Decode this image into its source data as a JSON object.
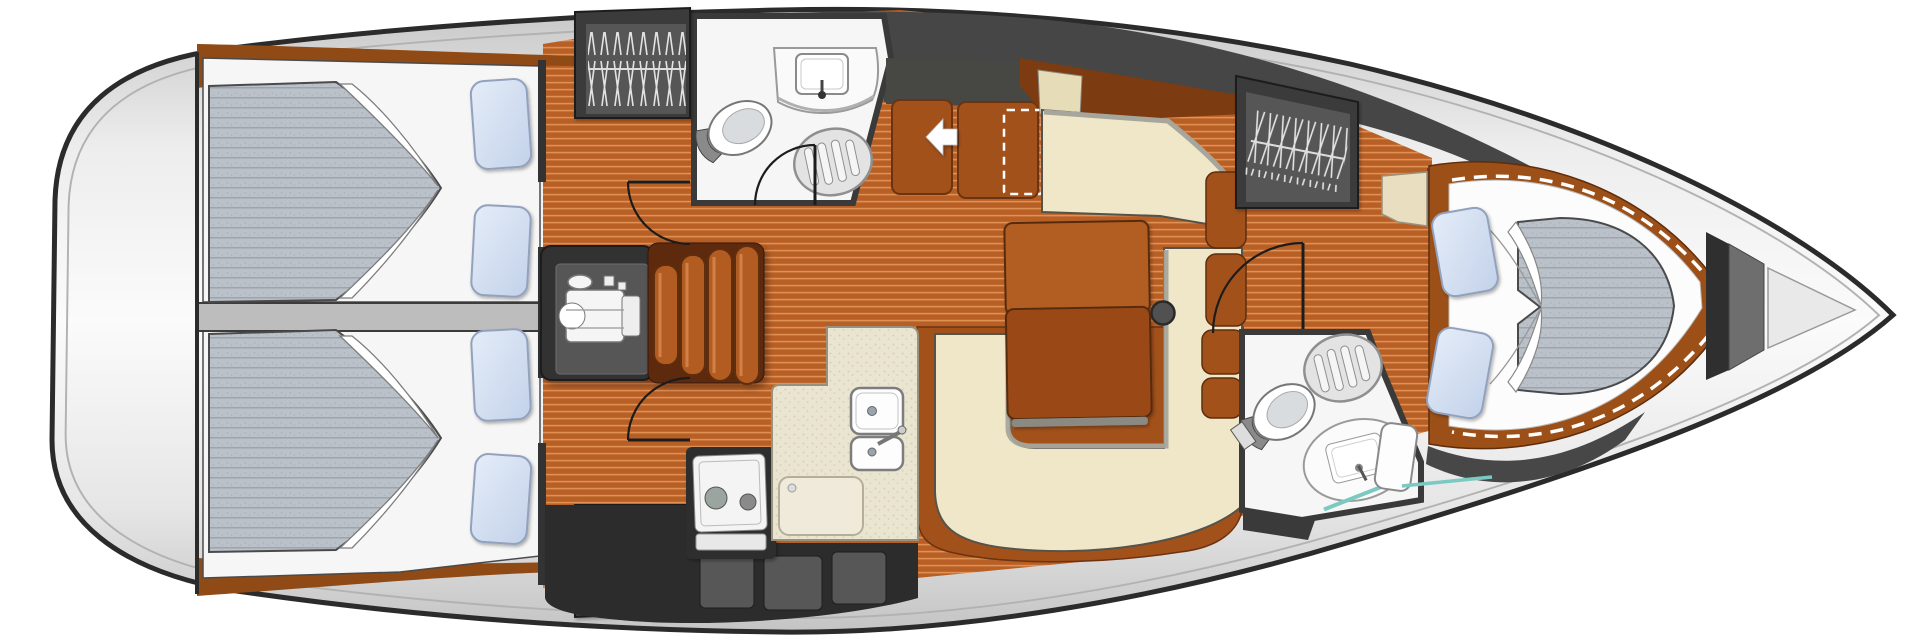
{
  "meta": {
    "title": "Sailing yacht interior layout — overhead deck plan",
    "view": "top-down floor plan",
    "orientation": {
      "bow": "right",
      "stern": "left"
    },
    "text_on_image": "none"
  },
  "vessel": {
    "rooms": [
      {
        "id": "stern-deck",
        "label": "Stern / transom deck",
        "contents": []
      },
      {
        "id": "aft-cabin-top",
        "label": "Aft double cabin (port side, top)",
        "contents": [
          "double berth mattress",
          "folded sheet",
          "2 pillows",
          "door to saloon"
        ]
      },
      {
        "id": "aft-cabin-bottom",
        "label": "Aft double cabin (starboard side, bottom)",
        "contents": [
          "double berth mattress",
          "folded sheet",
          "2 pillows",
          "door to saloon"
        ]
      },
      {
        "id": "engine-compartment",
        "label": "Engine compartment under companionway",
        "contents": [
          "engine schematic",
          "companionway steps"
        ]
      },
      {
        "id": "aft-head",
        "label": "Aft bathroom (top)",
        "contents": [
          "toilet",
          "washbasin with faucet",
          "round shower grate",
          "door"
        ]
      },
      {
        "id": "galley",
        "label": "Galley (bottom middle)",
        "contents": [
          "two-burner stove",
          "double sink with faucet",
          "worktop panel",
          "storage lockers"
        ]
      },
      {
        "id": "saloon",
        "label": "Saloon / dinette",
        "contents": [
          "U-shaped cream settee",
          "straight cream bench",
          "brown dining table",
          "mast compression post",
          "two brown companionway seats",
          "dashed optional-seat outline",
          "white direction arrow"
        ]
      },
      {
        "id": "forward-head",
        "label": "Forward bathroom (bottom right)",
        "contents": [
          "toilet",
          "washbasin with faucet",
          "round shower grate",
          "door to corridor"
        ]
      },
      {
        "id": "forward-cabin",
        "label": "Forward V-berth cabin",
        "contents": [
          "tapered double berth mattress",
          "folded sheet",
          "2 pillows",
          "vanity top",
          "small seat",
          "dashed infill outline"
        ]
      },
      {
        "id": "bow",
        "label": "Bow / anchor locker",
        "contents": [
          "bulkhead",
          "anchor locker triangle"
        ]
      }
    ],
    "wardrobes": [
      {
        "id": "hanging-locker-aft-top",
        "label": "Hanging locker with clothes hangers (top)"
      },
      {
        "id": "hanging-locker-aft-bottom",
        "label": "Han​ging locker with clothes hangers (bottom)"
      },
      {
        "id": "hanging-locker-forward",
        "label": "Hanging locker with clothes hangers (forward, top right)"
      }
    ],
    "symbols": [
      {
        "id": "companionway-arrow",
        "label": "White arrow pointing left (entry direction)"
      },
      {
        "id": "door-swing-arcs",
        "label": "Quarter-circle door swing arcs",
        "count": 4
      },
      {
        "id": "dashed-outlines",
        "label": "White dashed outlines (optional berth infill / seat)",
        "count": 3
      }
    ]
  },
  "colors": {
    "hull_outline": "#2b2b2b",
    "hull_light": "#fbfbfb",
    "hull_mid": "#e4e4e4",
    "hull_dark": "#c3c3c3",
    "deck_band": "#464646",
    "trim_brown": "#8f4a16",
    "trim_brown_dark": "#6b3310",
    "wood_base": "#b85f26",
    "wood_stripe": "#e99c5e",
    "wall_dark": "#3a3a3a",
    "locker_inner": "#565656",
    "hanger": "#e3e3e3",
    "room_white": "#f6f6f6",
    "mattress_base": "#bac1c9",
    "mattress_stripe": "#99a1ab",
    "pillow_base": "#c3d2ea",
    "pillow_light": "#e4ecf8",
    "pillow_edge": "#92a1bd",
    "cream": "#efe7c8",
    "gray_trim": "#a6a69c",
    "seat_brown": "#a2511b",
    "table_light": "#b25d20",
    "table_dark": "#9a4a16",
    "counter": "#eae5d0",
    "counter_dot": "#d6cfb2",
    "cabinet_dark": "#2c2c2c",
    "cabinet_face": "#575757",
    "teal": "#7cc9c2",
    "steps_brown": "#b35c22",
    "door_line": "#1c1c1c"
  }
}
